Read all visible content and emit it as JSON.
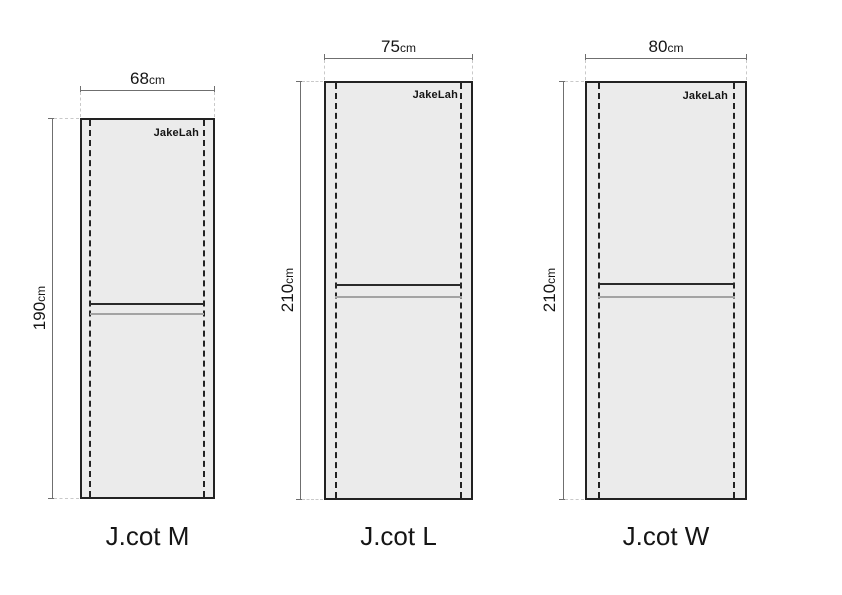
{
  "colors": {
    "background": "#ffffff",
    "panel_fill": "#ebebeb",
    "outline": "#222222",
    "rail_dark": "#2a2a2a",
    "rail_light": "#a3a3a3",
    "dimension_line": "#6f6f6f",
    "extension_line": "#c9c9c9",
    "text": "#151515"
  },
  "cots": [
    {
      "name": "J.cot M",
      "brand": "JakeLah",
      "width": {
        "value": "68",
        "unit": "cm"
      },
      "height": {
        "value": "190",
        "unit": "cm"
      }
    },
    {
      "name": "J.cot L",
      "brand": "JakeLah",
      "width": {
        "value": "75",
        "unit": "cm"
      },
      "height": {
        "value": "210",
        "unit": "cm"
      }
    },
    {
      "name": "J.cot W",
      "brand": "JakeLah",
      "width": {
        "value": "80",
        "unit": "cm"
      },
      "height": {
        "value": "210",
        "unit": "cm"
      }
    }
  ]
}
